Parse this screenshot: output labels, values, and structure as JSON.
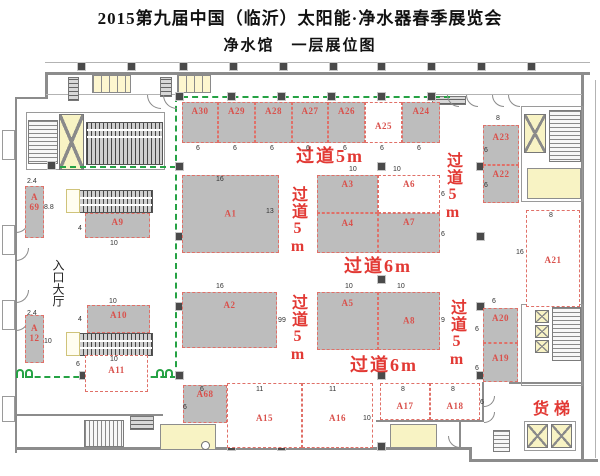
{
  "header": {
    "title": "2015第九届中国（临沂）太阳能·净水器春季展览会",
    "subtitle": "净水馆　一层展位图"
  },
  "colors": {
    "booth_gray": "#bdbdbd",
    "label_red": "#d9514c",
    "aisle_red": "#e23934",
    "dash_red": "#e07068",
    "path_green": "#25a244",
    "wall": "#8c8c8c",
    "yellow": "#f8f3c4",
    "column": "#4a4a4a"
  },
  "texts": {
    "entrance": "入口大厅",
    "freight": "货梯"
  },
  "logo": {
    "cn": "荣事达",
    "en": "Royalstar"
  },
  "booths": [
    {
      "id": "A30",
      "label": "A30",
      "x": 182,
      "y": 102,
      "w": 36,
      "h": 41,
      "fill": "gray",
      "ly": 3
    },
    {
      "id": "A29",
      "label": "A29",
      "x": 218,
      "y": 102,
      "w": 37,
      "h": 41,
      "fill": "gray",
      "ly": 3
    },
    {
      "id": "A28",
      "label": "A28",
      "x": 255,
      "y": 102,
      "w": 37,
      "h": 41,
      "fill": "gray",
      "ly": 3
    },
    {
      "id": "A27",
      "label": "A27",
      "x": 292,
      "y": 102,
      "w": 36,
      "h": 41,
      "fill": "gray",
      "ly": 3
    },
    {
      "id": "A26",
      "label": "A26",
      "x": 328,
      "y": 102,
      "w": 37,
      "h": 41,
      "fill": "gray",
      "ly": 3
    },
    {
      "id": "A25",
      "label": "A25",
      "x": 365,
      "y": 102,
      "w": 37,
      "h": 41,
      "fill": "white",
      "ly": 18
    },
    {
      "id": "A24",
      "label": "A24",
      "x": 402,
      "y": 102,
      "w": 38,
      "h": 41,
      "fill": "gray",
      "ly": 3
    },
    {
      "id": "A1",
      "label": "A1",
      "x": 182,
      "y": 175,
      "w": 97,
      "h": 78,
      "fill": "gray"
    },
    {
      "id": "A2",
      "label": "A2",
      "x": 182,
      "y": 292,
      "w": 95,
      "h": 56,
      "fill": "gray",
      "ly": 7
    },
    {
      "id": "A3",
      "label": "A3",
      "x": 317,
      "y": 175,
      "w": 61,
      "h": 38,
      "fill": "gray",
      "ly": 3
    },
    {
      "id": "A6",
      "label": "A6",
      "x": 378,
      "y": 175,
      "w": 62,
      "h": 38,
      "fill": "white",
      "ly": 3
    },
    {
      "id": "A4",
      "label": "A4",
      "x": 317,
      "y": 213,
      "w": 61,
      "h": 40,
      "fill": "gray",
      "ly": 4
    },
    {
      "id": "A7",
      "label": "A7",
      "x": 378,
      "y": 213,
      "w": 62,
      "h": 40,
      "fill": "gray",
      "ly": 3
    },
    {
      "id": "A5",
      "label": "A5",
      "x": 317,
      "y": 292,
      "w": 61,
      "h": 58,
      "fill": "gray",
      "ly": 5
    },
    {
      "id": "A8",
      "label": "A8",
      "x": 378,
      "y": 292,
      "w": 62,
      "h": 58,
      "fill": "gray"
    },
    {
      "id": "A23",
      "label": "A23",
      "x": 483,
      "y": 125,
      "w": 36,
      "h": 40,
      "fill": "gray",
      "ly": 6
    },
    {
      "id": "A22",
      "label": "A22",
      "x": 483,
      "y": 165,
      "w": 36,
      "h": 38,
      "fill": "gray",
      "ly": 3
    },
    {
      "id": "A21",
      "label": "A21",
      "x": 526,
      "y": 210,
      "w": 54,
      "h": 97,
      "fill": "white",
      "ly": 44
    },
    {
      "id": "A20",
      "label": "A20",
      "x": 483,
      "y": 308,
      "w": 35,
      "h": 35,
      "fill": "gray",
      "ly": 4
    },
    {
      "id": "A19",
      "label": "A19",
      "x": 483,
      "y": 343,
      "w": 35,
      "h": 39,
      "fill": "gray",
      "ly": 9
    },
    {
      "id": "A69",
      "label": "A 69",
      "x": 25,
      "y": 186,
      "w": 19,
      "h": 52,
      "fill": "gray",
      "ly": 5,
      "stack": true
    },
    {
      "id": "A12",
      "label": "A 12",
      "x": 25,
      "y": 315,
      "w": 19,
      "h": 48,
      "fill": "gray",
      "ly": 7,
      "stack": true
    },
    {
      "id": "A9",
      "label": "A9",
      "x": 85,
      "y": 213,
      "w": 65,
      "h": 25,
      "fill": "gray",
      "ly": 3
    },
    {
      "id": "A10",
      "label": "A10",
      "x": 87,
      "y": 305,
      "w": 63,
      "h": 28,
      "fill": "gray",
      "ly": 4
    },
    {
      "id": "A11",
      "label": "A11",
      "x": 85,
      "y": 355,
      "w": 63,
      "h": 37,
      "fill": "white",
      "ly": 9
    },
    {
      "id": "A68",
      "label": "A68",
      "x": 183,
      "y": 385,
      "w": 44,
      "h": 38,
      "fill": "gray",
      "ly": 3
    },
    {
      "id": "A15",
      "label": "A15",
      "x": 227,
      "y": 383,
      "w": 75,
      "h": 65,
      "fill": "white",
      "ly": 29
    },
    {
      "id": "A16",
      "label": "A16",
      "x": 302,
      "y": 383,
      "w": 71,
      "h": 65,
      "fill": "white",
      "ly": 29
    },
    {
      "id": "A17",
      "label": "A17",
      "x": 380,
      "y": 383,
      "w": 50,
      "h": 37,
      "fill": "white",
      "ly": 17
    },
    {
      "id": "A18",
      "label": "A18",
      "x": 430,
      "y": 383,
      "w": 50,
      "h": 37,
      "fill": "white",
      "ly": 17
    }
  ],
  "aisles": [
    {
      "text": "过道5m",
      "v": false,
      "x": 296,
      "y": 147,
      "s": 18
    },
    {
      "text": "过道5m",
      "v": true,
      "x": 444,
      "y": 152,
      "s": 16
    },
    {
      "text": "过道5m",
      "v": true,
      "x": 289,
      "y": 186,
      "s": 16
    },
    {
      "text": "过道5m",
      "v": true,
      "x": 289,
      "y": 294,
      "s": 16
    },
    {
      "text": "过道5m",
      "v": true,
      "x": 448,
      "y": 299,
      "s": 16
    },
    {
      "text": "过道6m",
      "v": false,
      "x": 344,
      "y": 257,
      "s": 18
    },
    {
      "text": "过道6m",
      "v": false,
      "x": 350,
      "y": 356,
      "s": 18
    }
  ],
  "dims": [
    [
      "6",
      196,
      145
    ],
    [
      "6",
      233,
      145
    ],
    [
      "6",
      270,
      145
    ],
    [
      "6",
      306,
      145
    ],
    [
      "6",
      343,
      145
    ],
    [
      "6",
      380,
      145
    ],
    [
      "6",
      417,
      145
    ],
    [
      "16",
      216,
      176
    ],
    [
      "13",
      266,
      208
    ],
    [
      "16",
      216,
      283
    ],
    [
      "9",
      278,
      317
    ],
    [
      "10",
      349,
      166
    ],
    [
      "10",
      393,
      166
    ],
    [
      "6",
      441,
      191
    ],
    [
      "6",
      441,
      231
    ],
    [
      "10",
      345,
      283
    ],
    [
      "10",
      397,
      283
    ],
    [
      "9",
      282,
      317
    ],
    [
      "9",
      441,
      317
    ],
    [
      "8",
      496,
      115
    ],
    [
      "6",
      484,
      147
    ],
    [
      "6",
      484,
      182
    ],
    [
      "6",
      492,
      298
    ],
    [
      "6",
      475,
      326
    ],
    [
      "6",
      475,
      365
    ],
    [
      "8",
      549,
      212
    ],
    [
      "16",
      516,
      249
    ],
    [
      "2.4",
      27,
      178
    ],
    [
      "8.8",
      44,
      204
    ],
    [
      "2.4",
      27,
      310
    ],
    [
      "10",
      44,
      338
    ],
    [
      "4",
      78,
      225
    ],
    [
      "10",
      110,
      240
    ],
    [
      "10",
      109,
      298
    ],
    [
      "4",
      78,
      316
    ],
    [
      "10",
      110,
      356
    ],
    [
      "6",
      76,
      361
    ],
    [
      "6",
      200,
      386
    ],
    [
      "6",
      183,
      404
    ],
    [
      "11",
      256,
      386
    ],
    [
      "11",
      329,
      386
    ],
    [
      "10",
      363,
      415
    ],
    [
      "8",
      401,
      386
    ],
    [
      "8",
      451,
      386
    ],
    [
      "6",
      480,
      399
    ]
  ]
}
